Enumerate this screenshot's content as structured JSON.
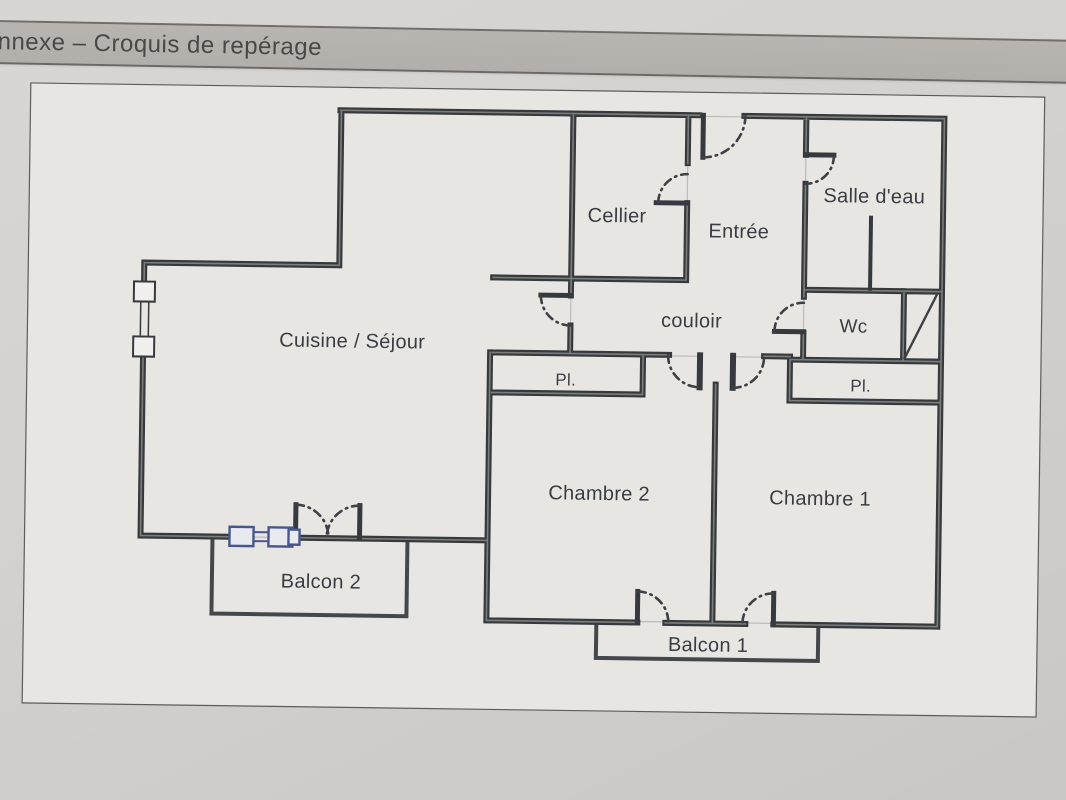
{
  "header": {
    "title": "nnexe – Croquis de repérage"
  },
  "plan": {
    "labels": {
      "cellier": "Cellier",
      "entree": "Entrée",
      "salle_deau": "Salle d'eau",
      "couloir": "couloir",
      "wc": "Wc",
      "placard_chambre2": "Pl.",
      "placard_chambre1": "Pl.",
      "cuisine_sejour": "Cuisine / Séjour",
      "chambre2": "Chambre 2",
      "chambre1": "Chambre 1",
      "balcon2": "Balcon 2",
      "balcon1": "Balcon 1"
    }
  },
  "colors": {
    "photo_bg": "#d4d2ce",
    "paper": "#e8e6e3",
    "page_border": "#5f5c58",
    "wall": "#363a3e",
    "balcony": "#45484b",
    "label": "#393d43",
    "band": "#b2afab",
    "band_text": "#4a4745",
    "window_accent": "#47568c"
  }
}
